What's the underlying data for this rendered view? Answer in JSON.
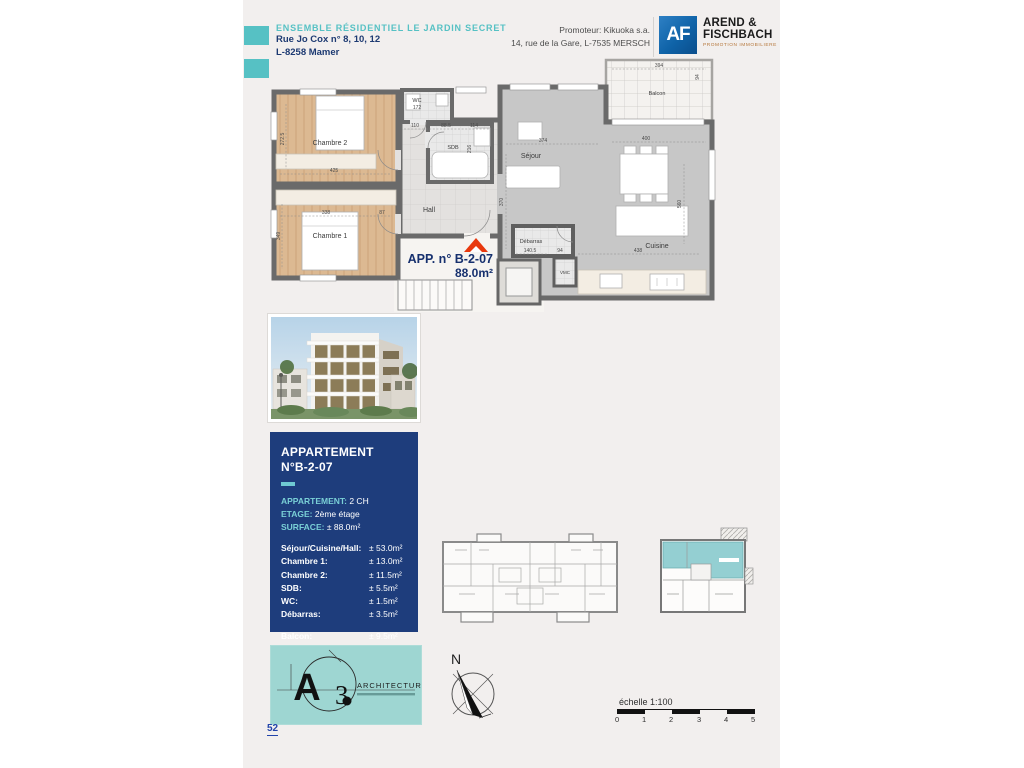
{
  "header": {
    "project_title": "ENSEMBLE RÉSIDENTIEL LE JARDIN SECRET",
    "address_line1": "Rue Jo Cox n° 8, 10, 12",
    "address_line2": "L-8258 Mamer",
    "promoter_line1": "Promoteur: Kikuoka s.a.",
    "promoter_line2": "14, rue de la Gare, L-7535 MERSCH",
    "developer_logo": {
      "monogram": "AF",
      "name_line1": "AREND &",
      "name_line2": "FISCHBACH",
      "subtitle": "PROMOTION IMMOBILIERE"
    }
  },
  "plan": {
    "marker": {
      "label": "APP. n° B-2-07",
      "area": "88.0m²"
    },
    "rooms": {
      "chambre2": "Chambre 2",
      "chambre1": "Chambre 1",
      "wc": "WC",
      "sdb": "SDB",
      "hall": "Hall",
      "sejour": "Séjour",
      "cuisine": "Cuisine",
      "debarras": "Débarras",
      "vmc": "VMC",
      "balcon": "Balcon"
    },
    "dims": {
      "chambre2_width": "425",
      "chambre2_height": "272.5",
      "chambre1_width": "338",
      "chambre1_height": "349",
      "hall_gap": "87",
      "wc_width": "172",
      "wc_below_1": "110",
      "wc_below_2": "88.5",
      "wc_below_3": "114",
      "sdb_height": "216",
      "sejour_width": "374",
      "sejour_height": "370",
      "dining_width": "400",
      "cuisine_width": "438",
      "cuisine_height": "560",
      "debarras_width": "140.5",
      "debarras_height": "94",
      "balcon_width": "394",
      "balcon_height": "94"
    }
  },
  "info_box": {
    "title_line1": "APPARTEMENT",
    "title_line2": "N°B-2-07",
    "fields": [
      {
        "label": "APPARTEMENT:",
        "value": "2 CH"
      },
      {
        "label": "ETAGE:",
        "value": "2ème étage"
      },
      {
        "label": "SURFACE:",
        "value": "± 88.0m²"
      }
    ],
    "rooms": [
      {
        "label": "Séjour/Cuisine/Hall:",
        "value": "± 53.0m²"
      },
      {
        "label": "Chambre 1:",
        "value": "± 13.0m²"
      },
      {
        "label": "Chambre 2:",
        "value": "± 11.5m²"
      },
      {
        "label": "SDB:",
        "value": "± 5.5m²"
      },
      {
        "label": "WC:",
        "value": "± 1.5m²"
      },
      {
        "label": "Débarras:",
        "value": "± 3.5m²"
      }
    ],
    "balcony": {
      "label": "Balcon:",
      "value": "± 9.5m²"
    }
  },
  "architect": {
    "initial_a": "A",
    "initial_3": "3",
    "title": "ARCHITECTURE"
  },
  "compass": {
    "label": "N"
  },
  "scale": {
    "label": "échelle 1:100",
    "ticks": [
      "0",
      "1",
      "2",
      "3",
      "4",
      "5"
    ]
  },
  "page_number": "52",
  "colors": {
    "teal": "#56c1c4",
    "navy": "#1e3d7c",
    "logo_blue": "#0f63a8",
    "red": "#e8380d"
  }
}
